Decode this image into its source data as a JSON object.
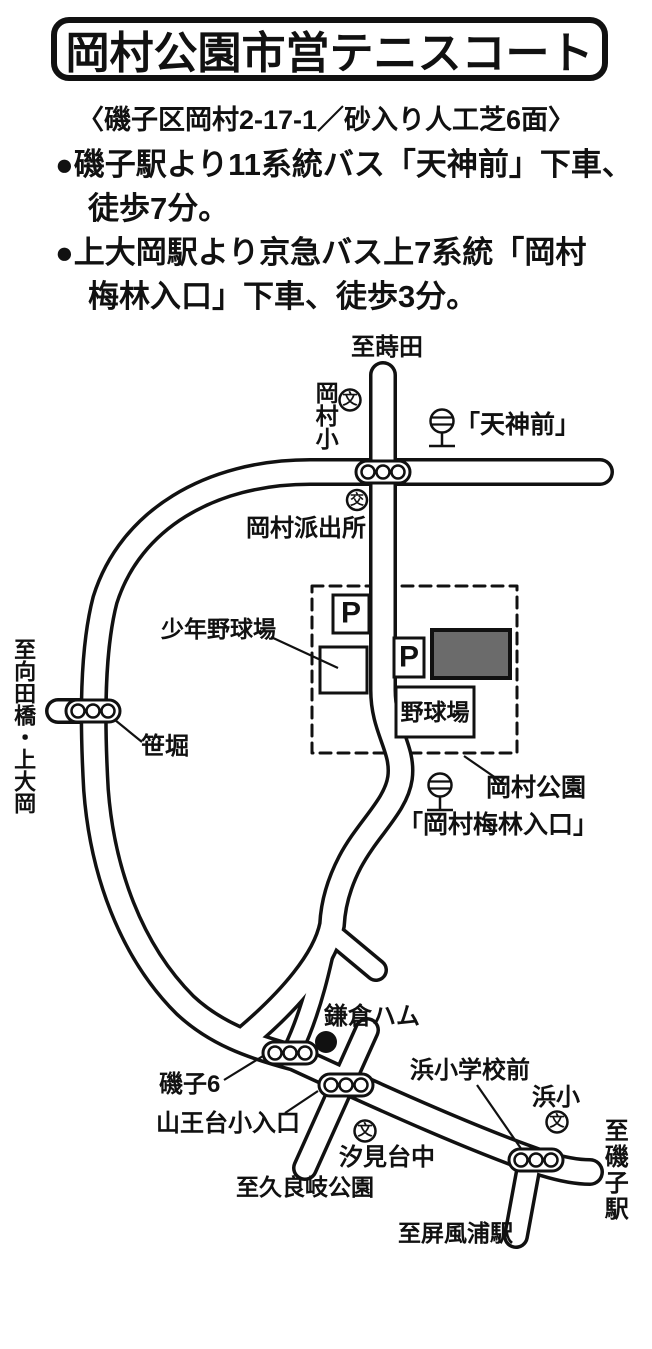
{
  "header": {
    "title": "岡村公園市営テニスコート",
    "address": "〈磯子区岡村2-17-1／砂入り人工芝6面〉",
    "bullet1_line1": "●磯子駅より11系統バス「天神前」下車、",
    "bullet1_line2": "徒歩7分。",
    "bullet2_line1": "●上大岡駅より京急バス上7系統「岡村",
    "bullet2_line2": "梅林入口」下車、徒歩3分。"
  },
  "map": {
    "labels": {
      "to_maita": "至蒔田",
      "okamura_elementary": "岡村小",
      "school_symbol": "文",
      "police_symbol": "交",
      "tenjinmae_stop": "「天神前」",
      "okamura_police_box": "岡村派出所",
      "youth_baseball_field": "少年野球場",
      "to_mukaidabashi_kamiooka": "至向田橋・上大岡",
      "sasabori": "笹堀",
      "parking": "P",
      "baseball_field": "野球場",
      "okamura_park": "岡村公園",
      "okamura_bairin_stop": "「岡村梅林入口」",
      "kamakura_ham": "鎌倉ハム",
      "isogo6": "磯子6",
      "sannodai_entrance": "山王台小入口",
      "to_kuraki_park": "至久良岐公園",
      "shiomidai_jhs": "汐見台中",
      "hama_school_front": "浜小学校前",
      "hama_elementary": "浜小",
      "to_isogo_station": "至磯子駅",
      "to_byobugaura_station": "至屏風浦駅"
    },
    "colors": {
      "line": "#111111",
      "tennis_court_fill": "#6b6b6b",
      "background": "#ffffff"
    }
  }
}
